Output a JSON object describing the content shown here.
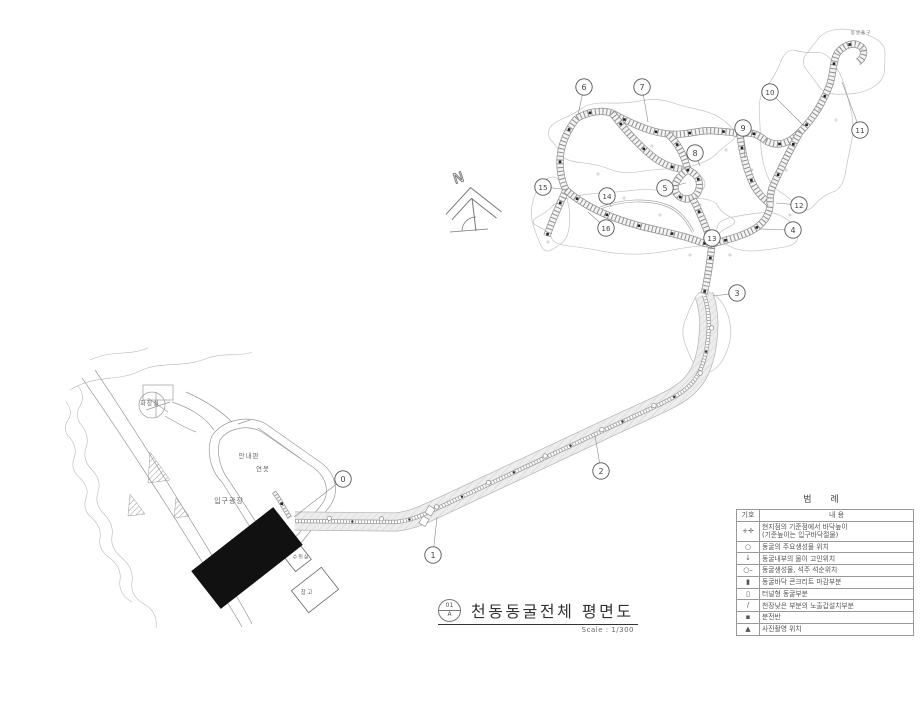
{
  "title_block": {
    "sheet_no": "01",
    "sheet_rev": "A",
    "title": "천동동굴전체 평면도",
    "scale": "Scale :  1/300"
  },
  "north": {
    "label": "N"
  },
  "legend": {
    "title": "범  례",
    "col_sym": "기호",
    "col_desc": "내  용",
    "rows": [
      {
        "sym": "+✛",
        "desc": "현지점의 기준점에서 바닥높이",
        "desc2": "(기준높이는 입구바닥절물)"
      },
      {
        "sym": "○",
        "desc": "동굴의 주요생성물 위치"
      },
      {
        "sym": "↓",
        "desc": "동굴내부의 물이 고인위치"
      },
      {
        "sym": "○–",
        "desc": "동굴생성물, 석주 석순위치"
      },
      {
        "sym": "▮",
        "desc": "동굴바닥 콘크리트 마감부분"
      },
      {
        "sym": "▯",
        "desc": "터널형 동굴부분"
      },
      {
        "sym": "/",
        "desc": "천장낮은 부분의 노출갑설치부분"
      },
      {
        "sym": "▪",
        "desc": "분전반"
      },
      {
        "sym": "▲",
        "desc": "사진촬영 위치"
      }
    ]
  },
  "site_labels": [
    {
      "text": "화장실",
      "x": 150,
      "y": 403,
      "size": 6
    },
    {
      "text": "안내판",
      "x": 249,
      "y": 455,
      "size": 6.5
    },
    {
      "text": "연못",
      "x": 263,
      "y": 468,
      "size": 6.5
    },
    {
      "text": "입구광장",
      "x": 229,
      "y": 501,
      "size": 7
    },
    {
      "text": "수위실",
      "x": 301,
      "y": 557,
      "size": 5
    },
    {
      "text": "창고",
      "x": 307,
      "y": 592,
      "size": 6
    },
    {
      "text": "동굴출구",
      "x": 861,
      "y": 33,
      "size": 4.5
    }
  ],
  "stations": [
    {
      "n": "0",
      "x": 343,
      "y": 479,
      "lx": 294,
      "ly": 517
    },
    {
      "n": "1",
      "x": 433,
      "y": 555,
      "lx": 437,
      "ly": 517
    },
    {
      "n": "2",
      "x": 601,
      "y": 471,
      "lx": 595,
      "ly": 436
    },
    {
      "n": "3",
      "x": 737,
      "y": 293,
      "lx": 713,
      "ly": 296
    },
    {
      "n": "4",
      "x": 793,
      "y": 230,
      "lx": 759,
      "ly": 229
    },
    {
      "n": "5",
      "x": 665,
      "y": 188,
      "lx": 686,
      "ly": 183
    },
    {
      "n": "6",
      "x": 584,
      "y": 87,
      "lx": 578,
      "ly": 115
    },
    {
      "n": "7",
      "x": 642,
      "y": 87,
      "lx": 648,
      "ly": 122
    },
    {
      "n": "8",
      "x": 695,
      "y": 153,
      "lx": 700,
      "ly": 166
    },
    {
      "n": "9",
      "x": 743,
      "y": 128,
      "lx": 745,
      "ly": 158
    },
    {
      "n": "10",
      "x": 770,
      "y": 92,
      "lx": 804,
      "ly": 126
    },
    {
      "n": "11",
      "x": 860,
      "y": 130,
      "lx": 842,
      "ly": 82
    },
    {
      "n": "12",
      "x": 799,
      "y": 205,
      "lx": 776,
      "ly": 203
    },
    {
      "n": "13",
      "x": 712,
      "y": 238,
      "lx": 712,
      "ly": 249
    },
    {
      "n": "14",
      "x": 607,
      "y": 196,
      "lx": 611,
      "ly": 207
    },
    {
      "n": "15",
      "x": 543,
      "y": 187,
      "lx": 562,
      "ly": 189
    },
    {
      "n": "16",
      "x": 606,
      "y": 228,
      "lx": 588,
      "ly": 212
    }
  ],
  "colors": {
    "line": "#8f8f8f",
    "band_fill": "#ebebeb",
    "building_fill": "#111111"
  }
}
